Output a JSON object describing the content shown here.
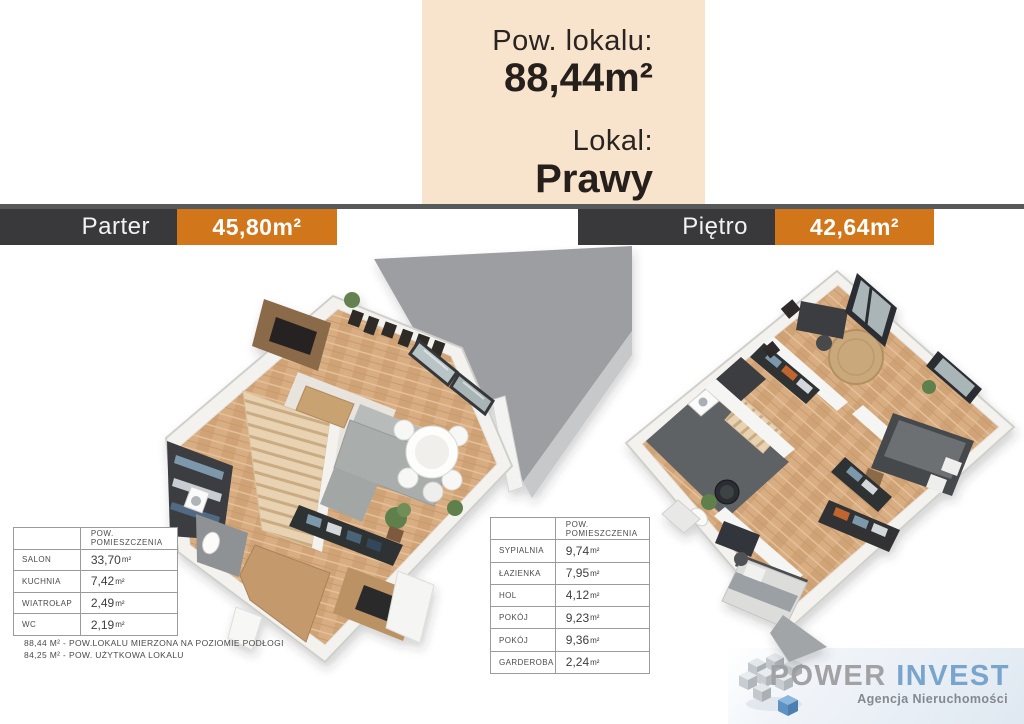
{
  "info_box": {
    "line1_label": "Pow. lokalu:",
    "line1_value": "88,44m²",
    "line2_label": "Lokal:",
    "line2_value": "Prawy"
  },
  "floor_headers": {
    "parter": {
      "name": "Parter",
      "area": "45,80m²"
    },
    "pietro": {
      "name": "Piętro",
      "area": "42,64m²"
    }
  },
  "area_tables": {
    "column_header": "POW. POMIESZCZENIA",
    "unit": "m²",
    "parter_rows": [
      {
        "label": "SALON",
        "value": "33,70"
      },
      {
        "label": "KUCHNIA",
        "value": "7,42"
      },
      {
        "label": "WIATROŁAP",
        "value": "2,49"
      },
      {
        "label": "WC",
        "value": "2,19"
      }
    ],
    "pietro_rows": [
      {
        "label": "SYPIALNIA",
        "value": "9,74"
      },
      {
        "label": "ŁAZIENKA",
        "value": "7,95"
      },
      {
        "label": "HOL",
        "value": "4,12"
      },
      {
        "label": "POKÓJ",
        "value": "9,23"
      },
      {
        "label": "POKÓJ",
        "value": "9,36"
      },
      {
        "label": "GARDEROBA",
        "value": "2,24"
      }
    ],
    "footnotes": [
      "88,44 M² - POW.LOKALU MIERZONA NA POZIOMIE PODŁOGI",
      "84,25 M² - POW. UŻYTKOWA LOKALU"
    ]
  },
  "branding": {
    "brand_primary": "POWER",
    "brand_secondary": "INVEST",
    "tagline": "Agencja Nieruchomości"
  },
  "colors": {
    "accent_orange": "#d2761c",
    "header_dark": "#39393b",
    "info_beige": "#f8e3cd",
    "brand_blue": "#79a5cd"
  }
}
